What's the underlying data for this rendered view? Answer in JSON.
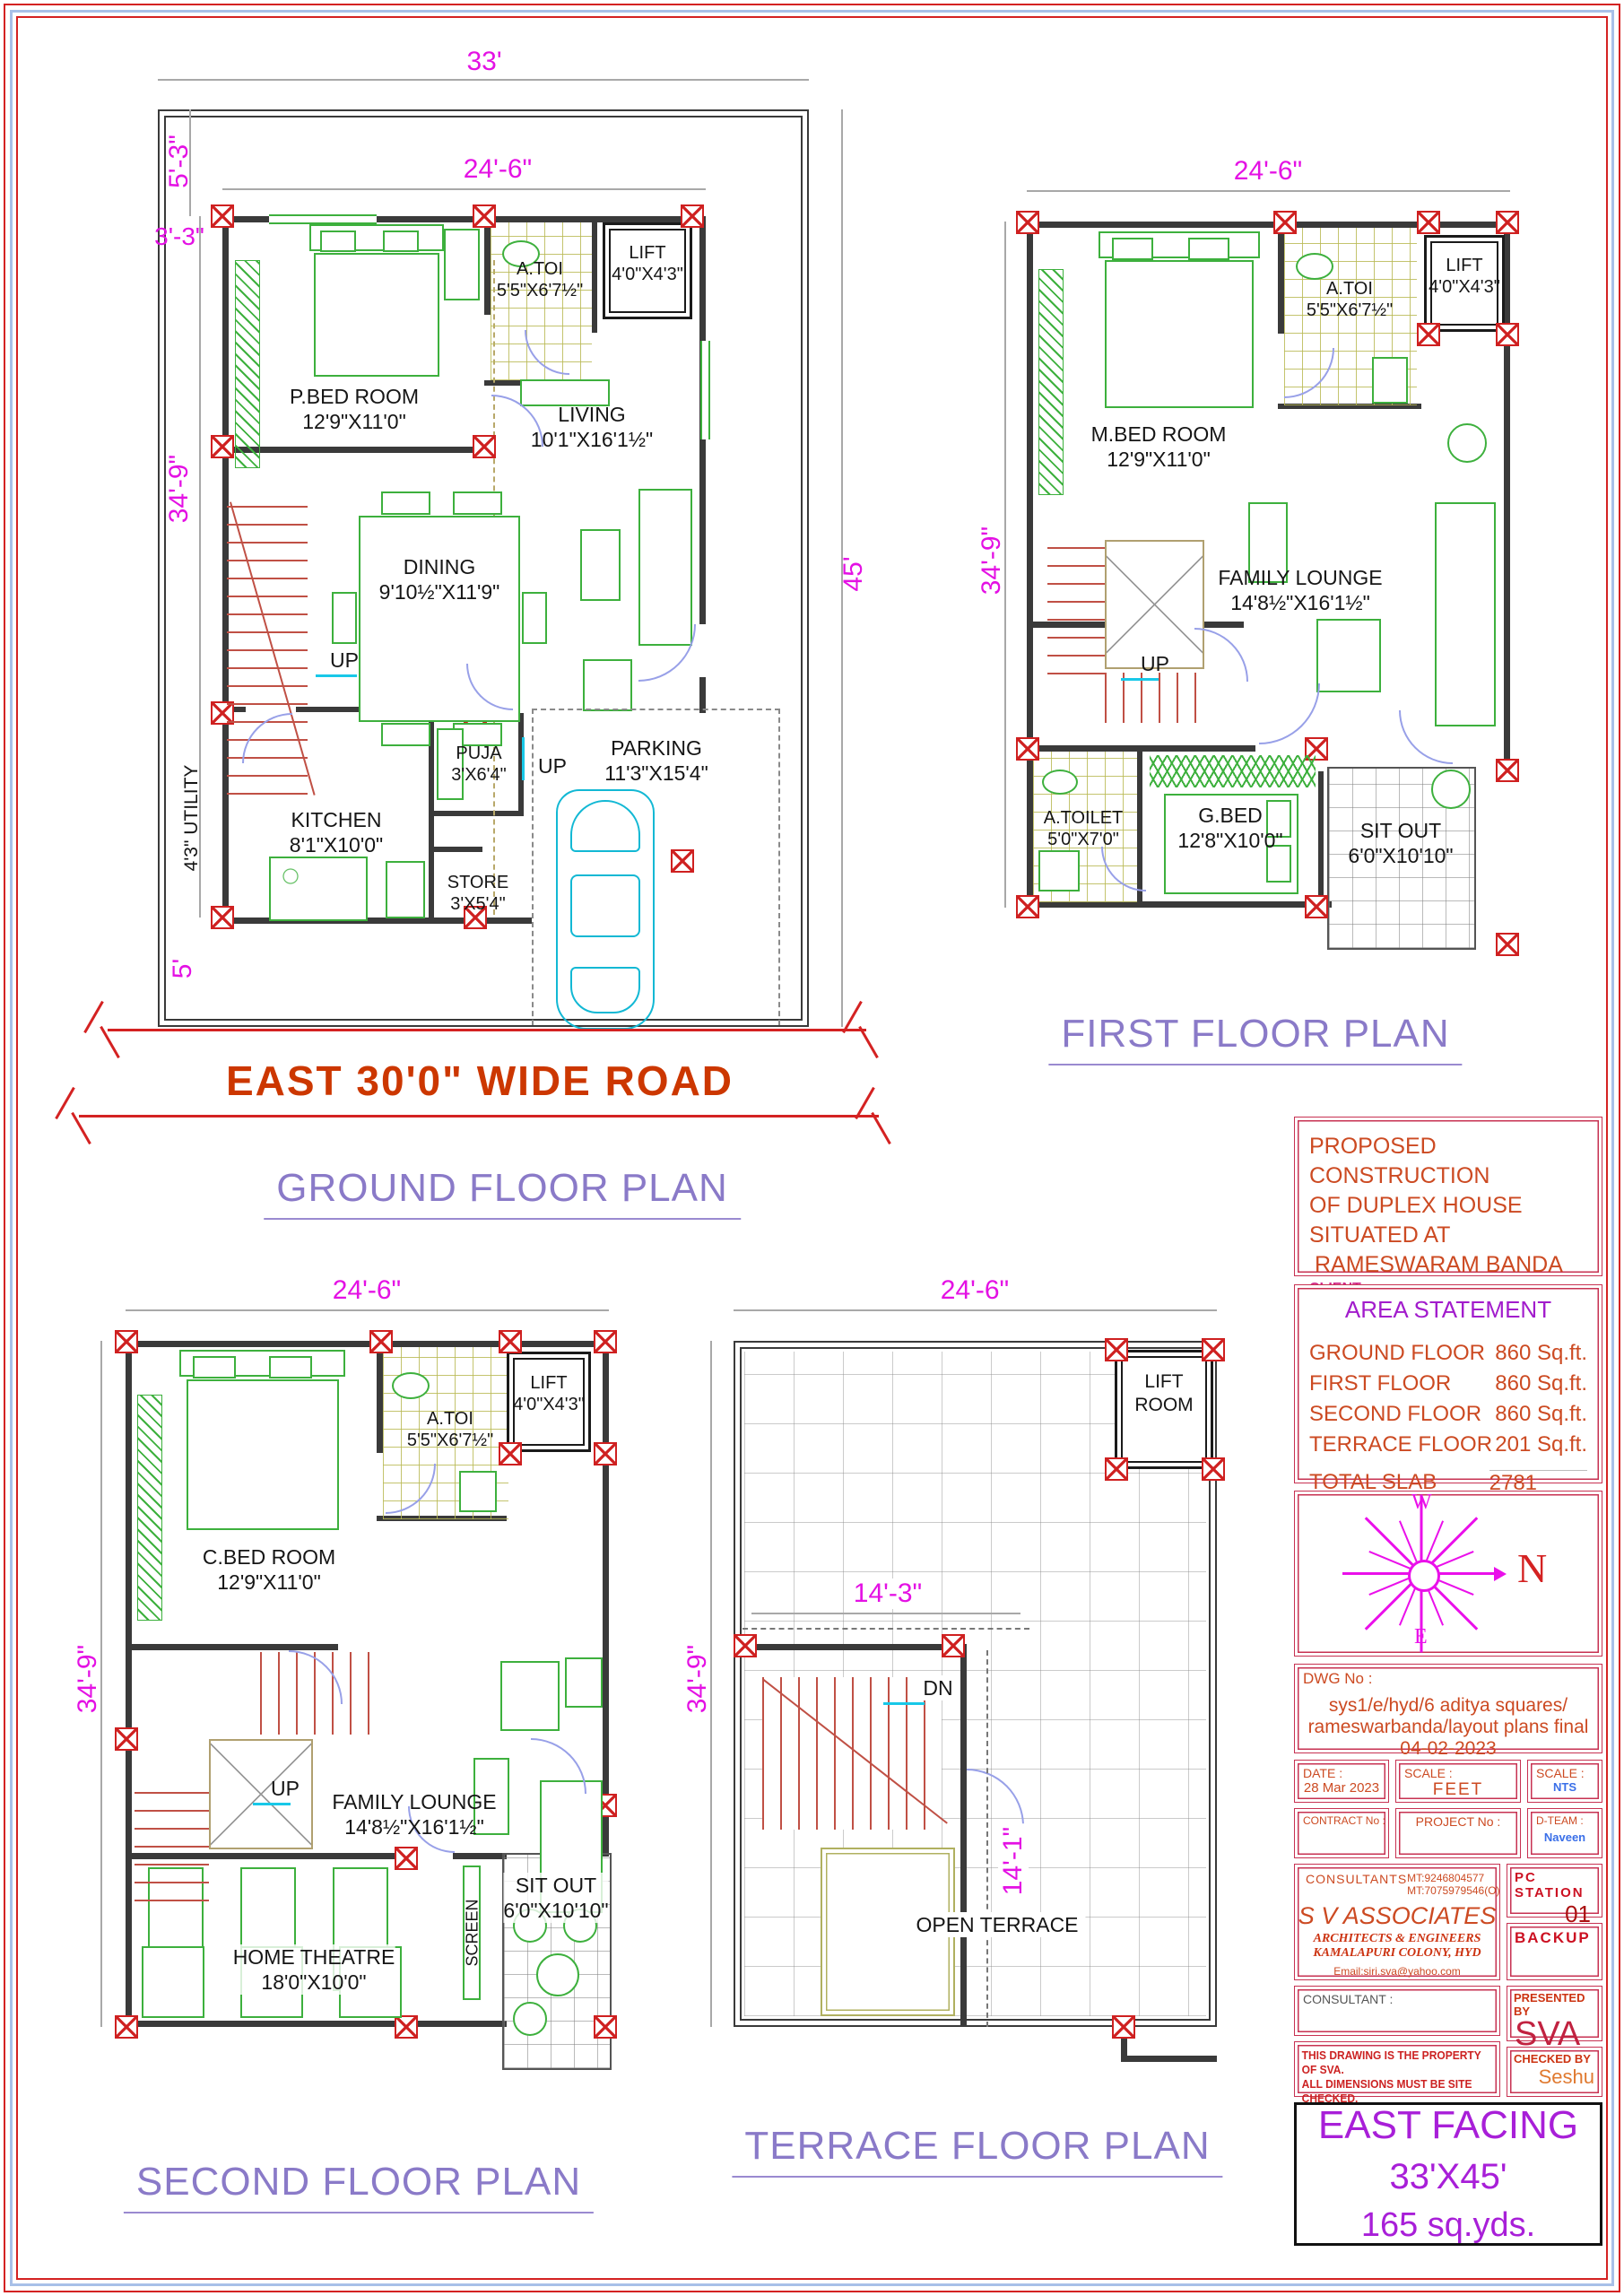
{
  "colors": {
    "dimension": "#e411e4",
    "heading": "#8a7ac8",
    "road_text": "#cc3700",
    "title_text": "#cc4a22",
    "title_border": "#c73252",
    "east_facing_text": "#a81fd8",
    "walls": "#3a3a3a",
    "columns": "#cf2020",
    "furniture": "#3db03d",
    "doors": "#98a0e8",
    "car": "#12b8d4",
    "stairs": "#c05045",
    "accent_blue": "#3a6fe8"
  },
  "gf": {
    "heading": "GROUND FLOOR PLAN",
    "road": "EAST 30'0\" WIDE ROAD",
    "utility": "4'3\" UTILITY",
    "up1": "UP",
    "up2": "UP",
    "dims": {
      "d33": "33'",
      "d53": "5'-3\"",
      "d246": "24'-6\"",
      "d33b": "3'-3\"",
      "d349": "34'-9\"",
      "d5": "5'",
      "d45": "45'"
    },
    "rooms": {
      "pbed": {
        "name": "P.BED ROOM",
        "size": "12'9\"X11'0\""
      },
      "atoi": {
        "name": "A.TOI",
        "size": "5'5\"X6'7½\""
      },
      "lift": {
        "name": "LIFT",
        "size": "4'0\"X4'3\""
      },
      "living": {
        "name": "LIVING",
        "size": "10'1\"X16'1½\""
      },
      "dining": {
        "name": "DINING",
        "size": "9'10½\"X11'9\""
      },
      "puja": {
        "name": "PUJA",
        "size": "3'X6'4\""
      },
      "kitchen": {
        "name": "KITCHEN",
        "size": "8'1\"X10'0\""
      },
      "store": {
        "name": "STORE",
        "size": "3'X5'4\""
      },
      "parking": {
        "name": "PARKING",
        "size": "11'3\"X15'4\""
      }
    }
  },
  "ff": {
    "heading": "FIRST FLOOR PLAN",
    "up": "UP",
    "dims": {
      "d246": "24'-6\"",
      "d349": "34'-9\""
    },
    "rooms": {
      "mbed": {
        "name": "M.BED ROOM",
        "size": "12'9\"X11'0\""
      },
      "atoi": {
        "name": "A.TOI",
        "size": "5'5\"X6'7½\""
      },
      "lift": {
        "name": "LIFT",
        "size": "4'0\"X4'3\""
      },
      "lounge": {
        "name": "FAMILY LOUNGE",
        "size": "14'8½\"X16'1½\""
      },
      "atoilet": {
        "name": "A.TOILET",
        "size": "5'0\"X7'0\""
      },
      "gbed": {
        "name": "G.BED",
        "size": "12'8\"X10'0\""
      },
      "sitout": {
        "name": "SIT OUT",
        "size": "6'0\"X10'10\""
      }
    }
  },
  "sf": {
    "heading": "SECOND FLOOR PLAN",
    "up": "UP",
    "screen": "SCREEN",
    "dims": {
      "d246": "24'-6\"",
      "d349": "34'-9\""
    },
    "rooms": {
      "cbed": {
        "name": "C.BED ROOM",
        "size": "12'9\"X11'0\""
      },
      "atoi": {
        "name": "A.TOI",
        "size": "5'5\"X6'7½\""
      },
      "lift": {
        "name": "LIFT",
        "size": "4'0\"X4'3\""
      },
      "lounge": {
        "name": "FAMILY LOUNGE",
        "size": "14'8½\"X16'1½\""
      },
      "theatre": {
        "name": "HOME THEATRE",
        "size": "18'0\"X10'0\""
      },
      "sitout": {
        "name": "SIT OUT",
        "size": "6'0\"X10'10\""
      }
    }
  },
  "tf": {
    "heading": "TERRACE FLOOR PLAN",
    "dn": "DN",
    "open": "OPEN TERRACE",
    "liftroom1": "LIFT",
    "liftroom2": "ROOM",
    "dims": {
      "d246": "24'-6\"",
      "d349": "34'-9\"",
      "d143": "14'-3\"",
      "d141": "14'-1\""
    }
  },
  "tb": {
    "proposed_l1": "PROPOSED CONSTRUCTION",
    "proposed_l2": "OF DUPLEX HOUSE",
    "proposed_l3": "SITUATED AT",
    "proposed_l4": "RAMESWARAM BANDA",
    "client_label": "CLIENT :",
    "client": "SRI ADITYA SQUARES",
    "area_title": "AREA STATEMENT",
    "areas": [
      {
        "label": "GROUND FLOOR",
        "value": "860 Sq.ft."
      },
      {
        "label": "FIRST FLOOR",
        "value": "860 Sq.ft."
      },
      {
        "label": "SECOND FLOOR",
        "value": "860 Sq.ft."
      },
      {
        "label": "TERRACE FLOOR",
        "value": "201 Sq.ft."
      }
    ],
    "total_label": "TOTAL SLAB AREA",
    "total_value": "2781 Sq.ft.",
    "compass": {
      "w": "W",
      "e": "E",
      "n": "N"
    },
    "dwg_label": "DWG No :",
    "dwg_l1": "sys1/e/hyd/6 aditya squares/",
    "dwg_l2": "rameswarbanda/layout plans final 04-02-2023",
    "date_label": "DATE :",
    "date": "28 Mar 2023",
    "scale1_label": "SCALE :",
    "scale1": "FEET",
    "scale2_label": "SCALE :",
    "scale2": "NTS",
    "contract_label": "CONTRACT No :",
    "project_label": "PROJECT No :",
    "dteam_label": "D-TEAM :",
    "dteam": "Naveen",
    "consultants_label": "CONSULTANTS",
    "phone1": "MT:9246804577",
    "phone2": "MT:7075979546(O)",
    "firm": "S V ASSOCIATES",
    "firm_sub1": "ARCHITECTS & ENGINEERS",
    "firm_sub2": "KAMALAPURI COLONY, HYD",
    "email": "Email:siri.sva@yahoo.com",
    "pc_label": "PC STATION",
    "pc": "01",
    "backup": "BACKUP",
    "consultant_label": "CONSULTANT :",
    "presented_label": "PRESENTED BY",
    "presented": "SVA",
    "checked_label": "CHECKED BY",
    "checked": "Seshu",
    "note_l1": "THIS DRAWING IS THE PROPERTY OF SVA.",
    "note_l2": "ALL DIMENSIONS MUST BE SITE CHECKED.",
    "note_l3": "ALL DIMENSIONS ARE IN FEET UNLESS SPECIFIED.",
    "east1": "EAST FACING",
    "east2": "33'X45'",
    "east3": "165 sq.yds."
  }
}
